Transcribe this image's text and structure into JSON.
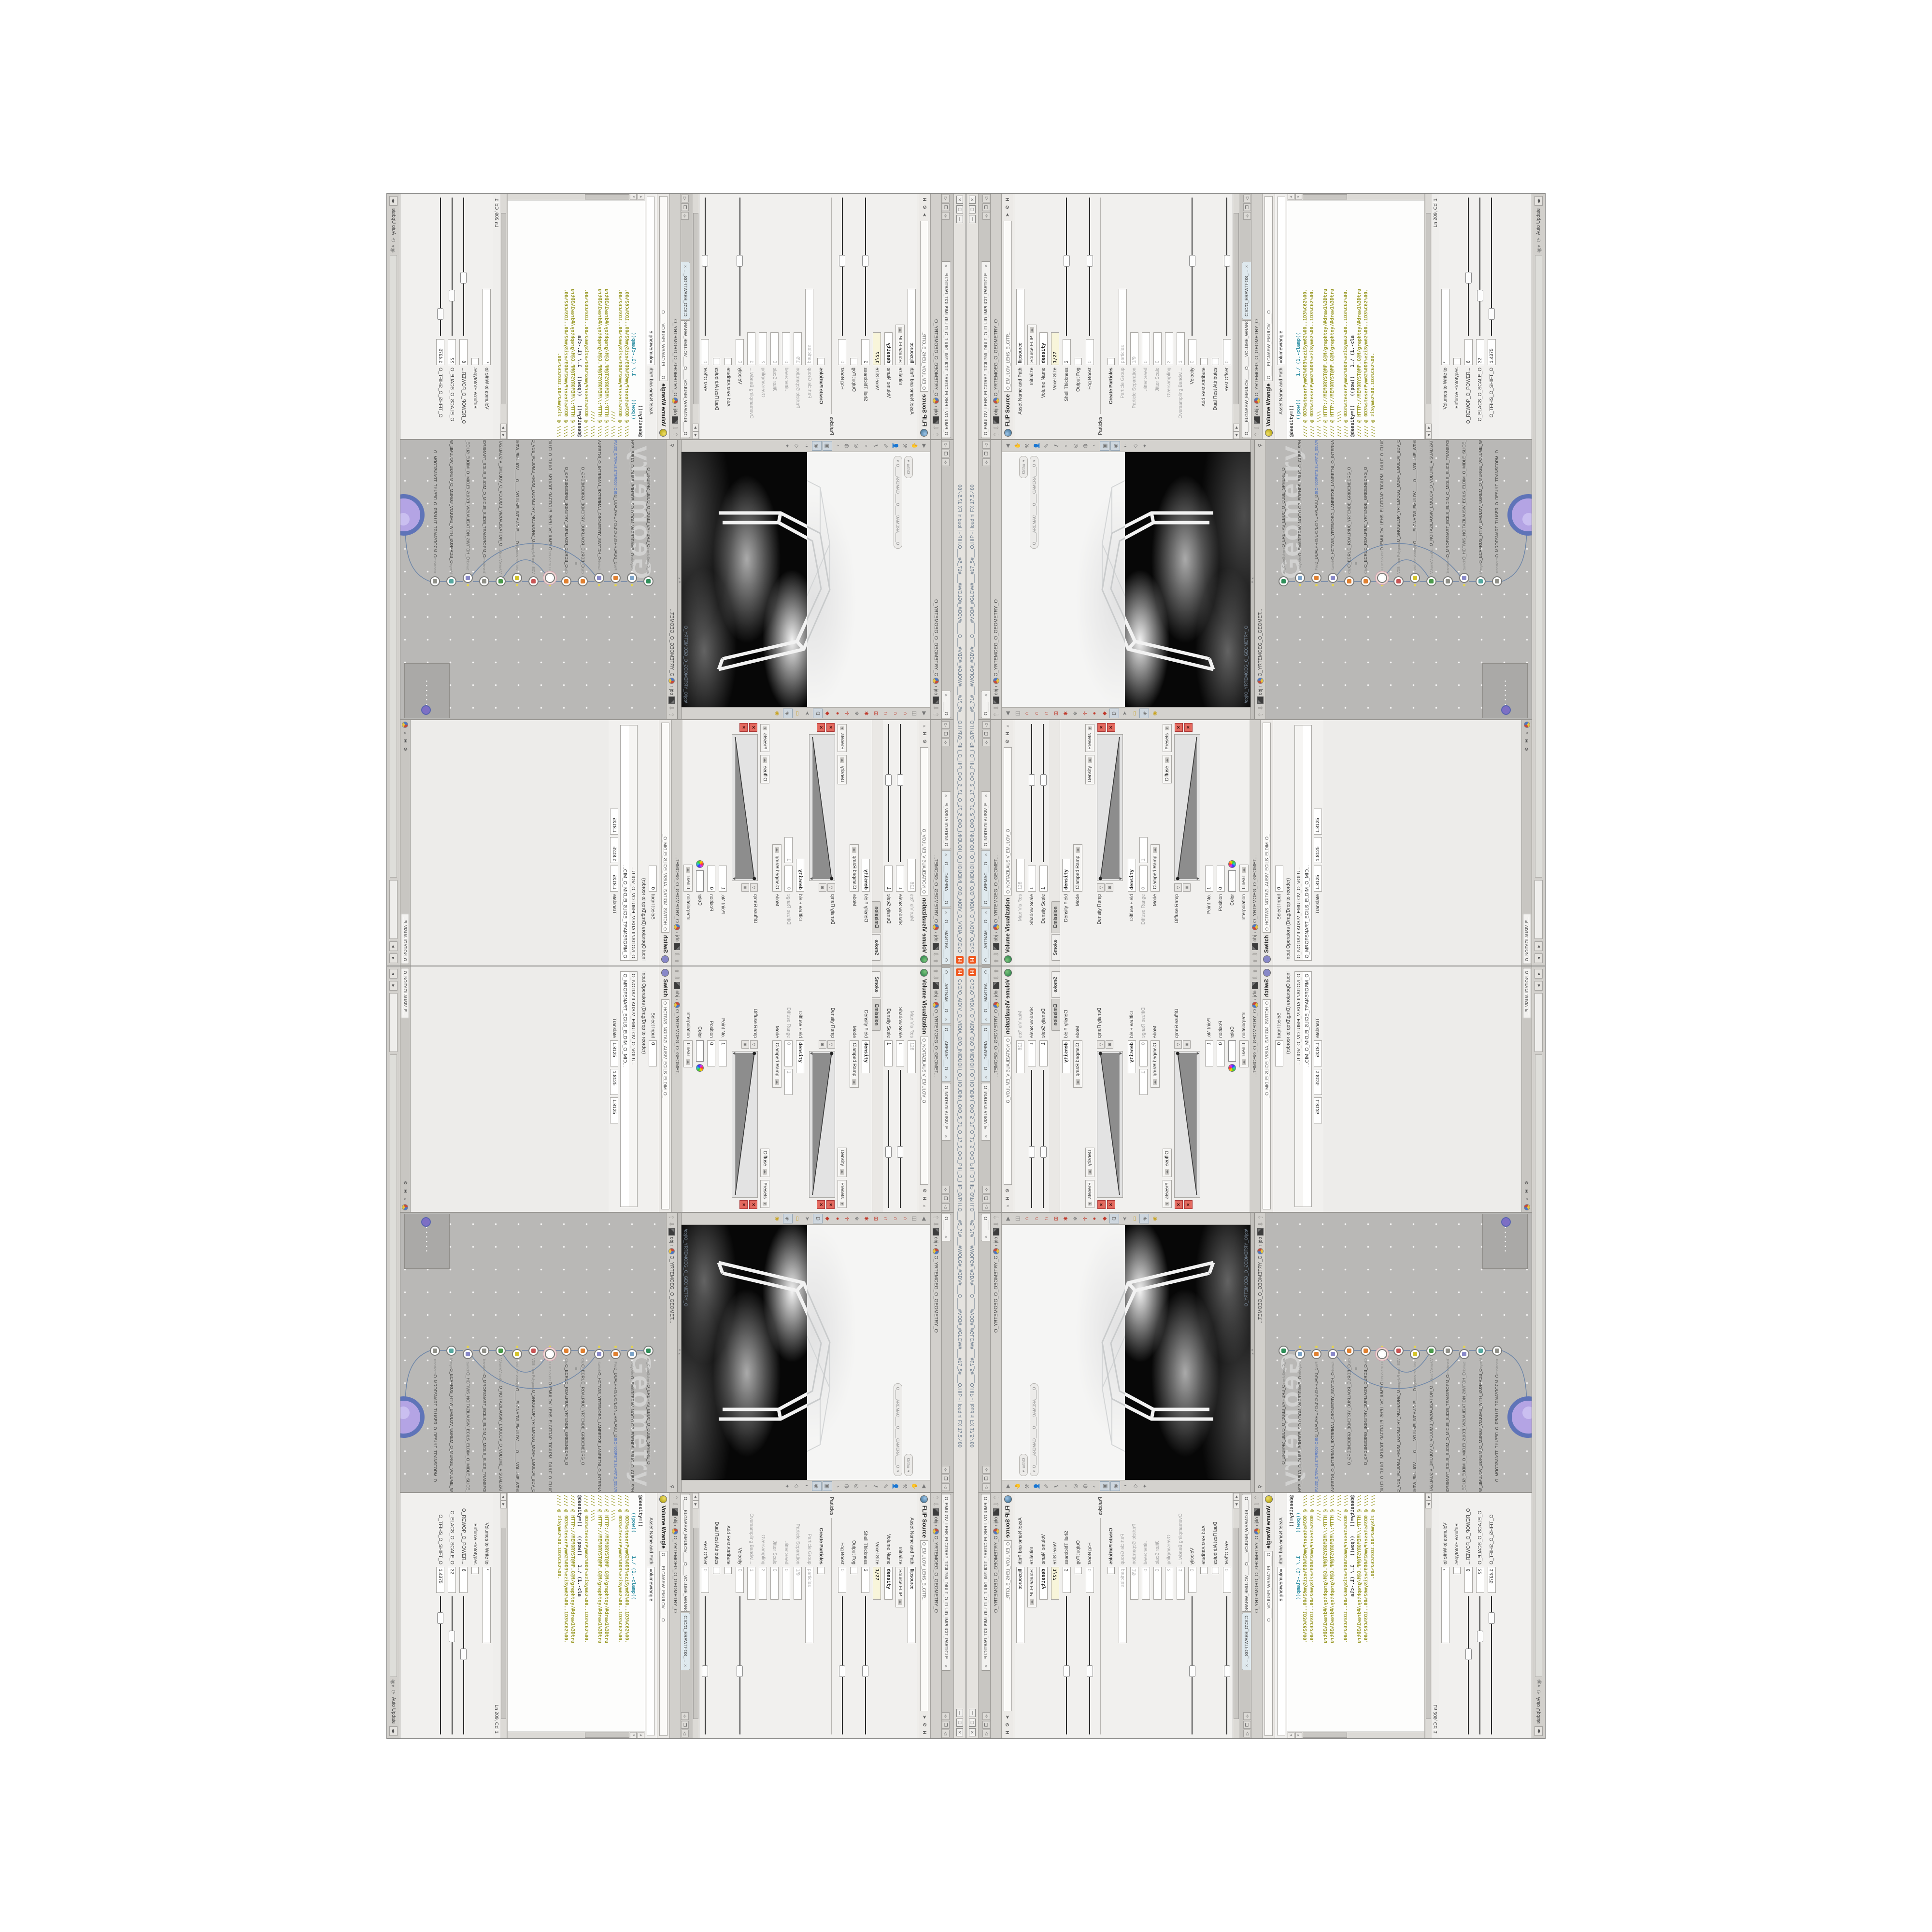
{
  "window": {
    "title": "C:/O/O_AIDIV_O_VIDIA_O/O_INIDUOH_O_HOUDINI_O/O_5_71_O_17_5_O/O_PIH_O_HIP_O/PIH.O___#5_71#___#WOLG#_#BDV#___O____#VDB#_#GLOW#___#17_5#___O.HIP - Houdini FX 17.5.480",
    "logo": "H",
    "buttons": {
      "minimize": "—",
      "restore": "❐",
      "close": "✕"
    }
  },
  "breadcrumbs": {
    "context": "obj",
    "sep": "›",
    "geometry": "O_YRTEMOEG_O_GEOMETRY_O",
    "geometry_short": "O_YRTEMOEG_O_GEOMET..."
  },
  "left_pane": {
    "tabs": [
      {
        "label": "O____ARTNAM___O...",
        "active": false
      },
      {
        "label": "O____AREMAC___O...",
        "active": false
      },
      {
        "label": "O_NOITAZILAUSIV_E...",
        "active": true
      }
    ],
    "title": "Volume Visualization",
    "title_field": "O_NOITAZILAUSIV_EMULOV_O",
    "rows": [
      {
        "kind": "field",
        "label": "Max Vis Res",
        "value": "128",
        "grey": true
      },
      {
        "kind": "slider",
        "label": "Shadow Scale",
        "value": "1",
        "f": 0.55
      },
      {
        "kind": "slider",
        "label": "Density Scale",
        "value": "1",
        "f": 0.55
      },
      {
        "kind": "ftabs",
        "tabs": [
          "Smoke",
          "Emission"
        ],
        "active": 0
      },
      {
        "kind": "field",
        "label": "Density Field",
        "value": "density",
        "bold": true
      },
      {
        "kind": "drop",
        "label": "Mode",
        "value": "Clamped Ramp"
      },
      {
        "kind": "footer",
        "a": "Density",
        "b": "Presets"
      },
      {
        "kind": "ramp",
        "label": "Density Ramp"
      },
      {
        "kind": "field",
        "label": "Diffuse Field",
        "value": "density",
        "bold": true
      },
      {
        "kind": "fields2",
        "label": "Diffuse Range",
        "v1": "0",
        "v2": "1",
        "grey": true
      },
      {
        "kind": "drop",
        "label": "Mode",
        "value": "Clamped Ramp"
      },
      {
        "kind": "footer",
        "a": "Diffuse",
        "b": "Presets"
      },
      {
        "kind": "ramp",
        "label": "Diffuse Ramp"
      },
      {
        "kind": "field",
        "label": "Point No.",
        "value": "1",
        "small": true
      },
      {
        "kind": "field",
        "label": "Position",
        "value": "0",
        "small": true
      },
      {
        "kind": "color",
        "label": "Color"
      },
      {
        "kind": "drop",
        "label": "Interpolation",
        "value": "Linear"
      }
    ],
    "switch": {
      "title": "Switch",
      "title_field": "O_HCTIWS_NOITAZILAUSIV_ECILS_ELDIM_O_",
      "rows": [
        {
          "kind": "field",
          "label": "Select Input",
          "value": "0",
          "small": true
        },
        {
          "kind": "label",
          "label": "Input Operators (Drag/Drop to reorder)"
        },
        {
          "kind": "list",
          "items": [
            "O_NOITAZILAUSIV_EMULOV_O_VOLU...",
            "O_MROFSNART_ECILS_ELDIM_O_MID..."
          ]
        },
        {
          "kind": "fields3",
          "label": "Translate",
          "v1": "1.8125",
          "v2": "1.8125",
          "v3": "1.8125"
        }
      ],
      "minitab": "O_NOITAZILAUSIV_E..."
    }
  },
  "scene_view": {
    "tab": "O____...",
    "pills": {
      "view": "Ortho",
      "camera": "O____AREMAC____O____CAMERA____O"
    },
    "path": "/obj/O_YRTEMOEG_O_GEOMETRY_O"
  },
  "network": {
    "watermark": "Geometry",
    "white_dots": "• • • • • •",
    "nodes": [
      {
        "type": "an_CubeSphere",
        "name": "O_EREHPS_EBUC_O_CUBE_SPHERE_O",
        "color": "#2e8f5a",
        "flag": false,
        "sel": false
      },
      {
        "type": "PolyWire",
        "name": "O_EMARFERIW_NOGYLOP_EREHPS_EBUC_O_CUBE_SPHERE_POLYGON_WIREFRAME_O",
        "color": "#7ba3c8",
        "flag": true,
        "sel": false
      },
      {
        "type": "File",
        "name": "D_DUALPR@/E@/E@NURPLAUD_D",
        "file": "JBO.NO3PETS.SLAIRT.D_55LVRG_O_GRVL55_D.TRIALS.STEP3ON.OBJ",
        "color": "#e08030",
        "flag": true,
        "sel": false
      },
      {
        "type": "Switch",
        "name": "O_HCTIWS_YRTEMOEG_LANRETXE_LANRETNI_O_INTERNAL_EXTERNAL_GEOMETRY_SWITCH_O",
        "color": "#8888c8",
        "flag": true,
        "sel": false
      },
      {
        "type": "Clip",
        "name": "O_ECRUD_ROALPIUC_YRTENDE_GRIDENEDRG_O",
        "color": "#e08030",
        "flag": false,
        "sel": false
      },
      {
        "type": "Clip",
        "name": "O_ECRUD_ROALPIUC_YRTENDE_GRIDENEDRG_O",
        "color": "#e08030",
        "flag": false,
        "sel": false
      },
      {
        "type": "FLIP Source",
        "name": "O_EMULOV_LEHS_ELCITRAP_TICILPMI_DIULF_O_FLUID_IMPLICIT_PARTICLE_SHEL_VOLUME_O",
        "color": "#ffffff",
        "flag": true,
        "sel": true
      },
      {
        "type": "VDB from Polygons",
        "name": "O_SNOGILOP_YRTEMOEG_MORF_EMULOV_BDV_O_VDB_VOLUME_FROM_GEOMETRY_POLYGONS_O",
        "color": "#c85555",
        "flag": false,
        "sel": false
      },
      {
        "type": "Volume Wrangle",
        "name": "O____ELGNARW_EMULOV____O____VOLUME_WRANGLE____O",
        "color": "#d4c32a",
        "flag": true,
        "sel": false
      },
      {
        "type": "VolumeVisualiz...",
        "name": "O_NOITAZILAUSIV_EMULOV_O_VOLUME_VISUALIZATION_O",
        "color": "#4a9a4a",
        "flag": false,
        "sel": false
      },
      {
        "type": "Transform",
        "name": "O_MROFSNART_ECILS_ELDIM_O_MIDLE_SLICE_TRANSFORM_O",
        "color": "#909088",
        "flag": false,
        "sel": false
      },
      {
        "type": "Switch",
        "name": "O_HCTIWS_NOITAZILAUSIV_ECILS_ELDIM_O_MIDLE_SLICE_VISUALIZATION_SWITCH_O",
        "color": "#8888c8",
        "flag": true,
        "sel": false
      },
      {
        "type": "Merge",
        "name": "O_ECAFRUS_HTIW_EMULOV_EGREM_O_MERGE_VOLUME_WITH_SURFACE_O",
        "color": "#55a8a0",
        "flag": false,
        "sel": false
      },
      {
        "type": "Transform",
        "name": "O_MROFSNART_TLUSER_O_RESULT_TRANSFORM_O",
        "color": "#909088",
        "flag": false,
        "sel": false
      }
    ]
  },
  "flip_pane": {
    "tab": "O_EMULOV_LEHS_ELCITRAP_TICILPMI_DIULF_O_FLUID_IMPLICIT_PARTICLE...",
    "title": "FLIP Source",
    "title_field": "O_EMULOV_LEHS_ELCITR...",
    "rows": [
      {
        "kind": "field",
        "label": "Asset Name and Path",
        "value": "flipsource",
        "wide": true
      },
      {
        "kind": "drop",
        "label": "Initialize",
        "value": "Source FLIP"
      },
      {
        "kind": "field",
        "label": "Volume Name",
        "value": "density",
        "bold": true
      },
      {
        "kind": "field",
        "label": "Voxel Size",
        "value": "1/27",
        "cream": true
      },
      {
        "kind": "slider",
        "label": "Shell Thickness",
        "value": "3",
        "f": 0.5
      },
      {
        "kind": "check",
        "label": "Output Fog",
        "checked": false
      },
      {
        "kind": "slider",
        "label": "Fog Boost",
        "value": "0",
        "grey": true,
        "f": 0.5
      },
      {
        "kind": "section",
        "label": "Particles"
      },
      {
        "kind": "check",
        "label": "Create Particles",
        "checked": false,
        "bold": true
      },
      {
        "kind": "field",
        "label": "Particle Group",
        "value": "particles",
        "grey": true,
        "wide": true
      },
      {
        "kind": "field",
        "label": "Particle Separation",
        "value": "1/9",
        "grey": true
      },
      {
        "kind": "field",
        "label": "Jitter Seed",
        "value": "0",
        "grey": true
      },
      {
        "kind": "field",
        "label": "Jitter Scale",
        "value": "0",
        "grey": true
      },
      {
        "kind": "field",
        "label": "Oversampling",
        "value": "2",
        "grey": true
      },
      {
        "kind": "field",
        "label": "Oversampling Bandwi...",
        "value": "1",
        "grey": true
      },
      {
        "kind": "slider",
        "label": "Velocity",
        "value": "0",
        "grey": true,
        "f": 0.5
      },
      {
        "kind": "check",
        "label": "Add Rest Attribute",
        "checked": false
      },
      {
        "kind": "check",
        "label": "Dual Rest Attributes",
        "checked": false
      },
      {
        "kind": "slider",
        "label": "Rest Offset",
        "value": "0",
        "grey": true,
        "f": 0.5
      }
    ]
  },
  "wrangle_pane": {
    "tabs": [
      {
        "label": "O____ELGNARW_EMULOV____O____VOLUME_WRANGL...",
        "active": true
      },
      {
        "label": "C:/O/O_ERAWTFOS_...",
        "active": false
      }
    ],
    "title": "Volume Wrangle",
    "title_field": "O____ELGNARW_EMULOV____O",
    "asset_label": "Asset Name and Path",
    "asset_value": "volumewrangle",
    "code_lines": [
      {
        "cls": "k",
        "text": "@density=(("
      },
      {
        "cls": "t",
        "text": "      ((pow((        1./ (1.-clamp(("
      },
      {
        "cls": "c",
        "text": "//// @ 0D3%steserPym62%0D3%eziSym62%00..1D3%C62%00."
      },
      {
        "cls": "c",
        "text": "//// @ 0D3%steserPym62%0D3%eziSym62%00..1D3%C62%00."
      },
      {
        "cls": "c",
        "text": "//// \\\\\\\\"
      },
      {
        "cls": "c",
        "text": "//// @ HTTP://MEMORYST@MP.C@M/graphtoy/#draw1%3Dtru"
      },
      {
        "cls": "c",
        "text": "//// @ HTTP://MEMORYST@MP.C@M/graphtoy/#draw1%3Dtru"
      },
      {
        "cls": "c",
        "text": "//// \\\\\\\\"
      },
      {
        "cls": "c",
        "text": "//// @ 0D3%steserPym62%0D3%eziSym62%00..1D3%C62%00."
      },
      {
        "cls": "k",
        "text": "@density=((   ((pow((   1./ (1.-cla"
      },
      {
        "cls": "c",
        "text": "//// @ HTTP://MEMORYST@MP.C@M/graphtoy/#draw1%3Dtru"
      },
      {
        "cls": "c",
        "text": "//// @ 0D3%steserPym62%0D3%eziSym62%00..1D3%C62%00."
      },
      {
        "cls": "c",
        "text": "//// @ ziSym62%00.1D3%C62%00."
      }
    ],
    "status": "Ln 209, Col 1",
    "rows": [
      {
        "kind": "field",
        "label": "Volumes to Write to",
        "value": "*",
        "wide": true
      },
      {
        "kind": "check",
        "label": "Enforce Prototypes",
        "checked": false
      },
      {
        "kind": "slider",
        "label": "O_REWOP_O_POWER...",
        "value": "6",
        "f": 0.38
      },
      {
        "kind": "slider",
        "label": "O_ELACS_O_SCALE_O",
        "value": "32",
        "f": 0.25
      },
      {
        "kind": "slider",
        "label": "O_TFIHS_O_SHIFT_O",
        "value": "1.4375",
        "f": 0.12
      }
    ]
  },
  "bottom_bar": {
    "auto_update": "Auto Update",
    "nav": "◀▶"
  },
  "colors": {
    "accent_orange": "#f0581e",
    "olive_code": "#9a9a28",
    "teal_code": "#2e8fa3",
    "net_bg": "#b9b8b6",
    "viewport_black": "#070707"
  }
}
